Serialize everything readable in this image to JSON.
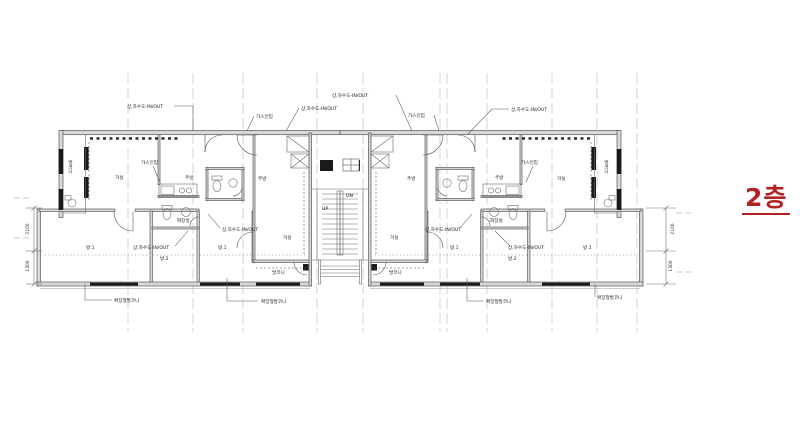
{
  "floor_badge": {
    "text": "2층",
    "color": "#b22222"
  },
  "plan": {
    "annotations": {
      "water_inout": "상,하수도-IN/OUT",
      "gas_inlet": "가스인입",
      "extended_balcony": "확장형발코니"
    },
    "rooms": {
      "living": "거실",
      "kitchen": "주방",
      "bathroom": "화장실",
      "room1": "방.1",
      "room2": "방.2",
      "balcony": "발코니"
    },
    "stair": {
      "up": "UP",
      "down": "DN"
    },
    "dimensions": {
      "upper": "2100",
      "lower": "1300"
    }
  }
}
